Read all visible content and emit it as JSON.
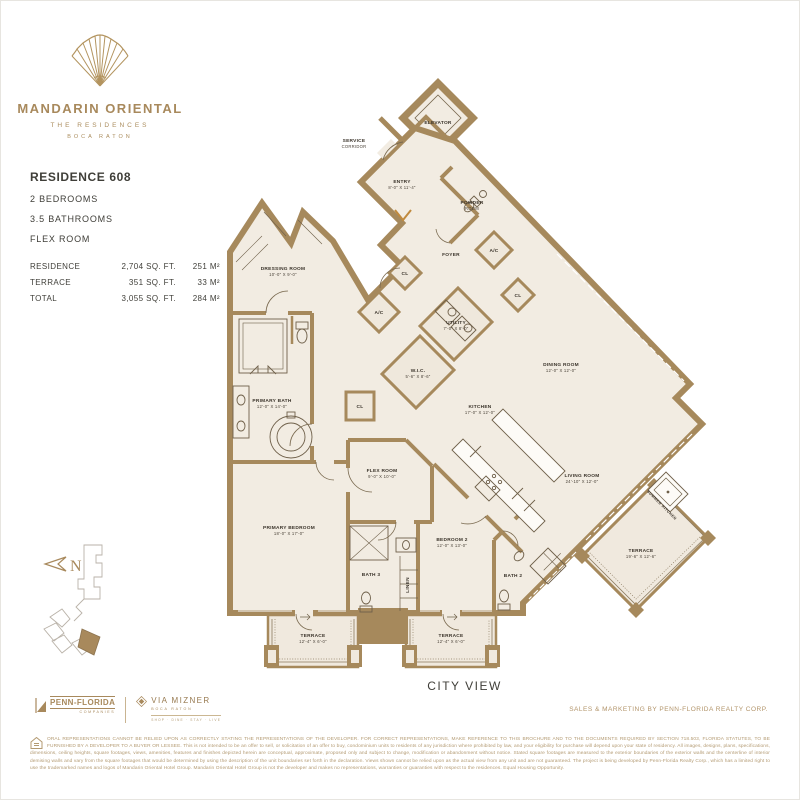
{
  "brand": {
    "name": "MANDARIN ORIENTAL",
    "line1": "THE RESIDENCES",
    "line2": "BOCA RATON"
  },
  "unit": {
    "title": "RESIDENCE 608",
    "features": [
      "2 BEDROOMS",
      "3.5 BATHROOMS",
      "FLEX ROOM"
    ],
    "areas": [
      {
        "label": "RESIDENCE",
        "sqft": "2,704 SQ. FT.",
        "sqm": "251 M²"
      },
      {
        "label": "TERRACE",
        "sqft": "351 SQ. FT.",
        "sqm": "33 M²"
      },
      {
        "label": "TOTAL",
        "sqft": "3,055 SQ. FT.",
        "sqm": "284 M²"
      }
    ]
  },
  "plan": {
    "view_label": "CITY VIEW",
    "compass": "N",
    "rooms": [
      {
        "t1": "ELEVATOR",
        "x": 438,
        "y": 124
      },
      {
        "t1": "SERVICE",
        "t2": "CORRIDOR",
        "x": 354,
        "y": 142
      },
      {
        "t1": "ENTRY",
        "t2": "8'-0\" X 11'-4\"",
        "x": 402,
        "y": 183
      },
      {
        "t1": "POWDER",
        "t2": "ROOM",
        "x": 472,
        "y": 204
      },
      {
        "t1": "FOYER",
        "x": 451,
        "y": 256
      },
      {
        "t1": "A/C",
        "x": 494,
        "y": 252
      },
      {
        "t1": "CL",
        "x": 518,
        "y": 297
      },
      {
        "t1": "CL",
        "x": 405,
        "y": 275
      },
      {
        "t1": "A/C",
        "x": 379,
        "y": 314
      },
      {
        "t1": "DRESSING ROOM",
        "t2": "10'-0\" X 9'-0\"",
        "x": 283,
        "y": 270
      },
      {
        "t1": "UTILITY",
        "t2": "7'-0\" X 8'-0\"",
        "x": 456,
        "y": 324
      },
      {
        "t1": "W.I.C.",
        "t2": "5'-6\" X 8'-6\"",
        "x": 418,
        "y": 372
      },
      {
        "t1": "CL",
        "x": 360,
        "y": 408
      },
      {
        "t1": "PRIMARY BATH",
        "t2": "12'-0\" X 14'-0\"",
        "x": 272,
        "y": 402
      },
      {
        "t1": "KITCHEN",
        "t2": "17'-0\" X 12'-0\"",
        "x": 480,
        "y": 408
      },
      {
        "t1": "DINING ROOM",
        "t2": "12'-0\" X 12'-0\"",
        "x": 561,
        "y": 366
      },
      {
        "t1": "LIVING ROOM",
        "t2": "24'-10\" X 12'-0\"",
        "x": 582,
        "y": 477
      },
      {
        "t1": "PRIMARY BEDROOM",
        "t2": "18'-0\" X 17'-0\"",
        "x": 289,
        "y": 529
      },
      {
        "t1": "FLEX ROOM",
        "t2": "9'-0\" X 10'-0\"",
        "x": 382,
        "y": 472
      },
      {
        "t1": "BATH 3",
        "x": 371,
        "y": 576
      },
      {
        "t1": "LINEN",
        "x": 409,
        "y": 585,
        "r": -90
      },
      {
        "t1": "BEDROOM 2",
        "t2": "12'-0\" X 13'-0\"",
        "x": 452,
        "y": 541
      },
      {
        "t1": "BATH 2",
        "x": 513,
        "y": 577
      },
      {
        "t1": "TERRACE",
        "t2": "12'-4\" X 6'-0\"",
        "x": 313,
        "y": 637
      },
      {
        "t1": "TERRACE",
        "t2": "12'-4\" X 6'-0\"",
        "x": 451,
        "y": 637
      },
      {
        "t1": "TERRACE",
        "t2": "19'-6\" X 12'-6\"",
        "x": 641,
        "y": 552
      },
      {
        "t1": "SUMMER KITCHEN",
        "x": 661,
        "y": 506,
        "r": 45,
        "small": true
      }
    ]
  },
  "footer": {
    "penn_name": "PENN-FLORIDA",
    "penn_sub": "COMPANIES",
    "via_name": "VIA MIZNER",
    "via_sub": "BOCA RATON",
    "via_tagline": "SHOP · DINE · STAY · LIVE",
    "sales": "SALES & MARKETING BY PENN-FLORIDA REALTY CORP.",
    "disclaimer": "ORAL REPRESENTATIONS CANNOT BE RELIED UPON AS CORRECTLY STATING THE REPRESENTATIONS OF THE DEVELOPER. FOR CORRECT REPRESENTATIONS, MAKE REFERENCE TO THIS BROCHURE AND TO THE DOCUMENTS REQUIRED BY SECTION 718.503, FLORIDA STATUTES, TO BE FURNISHED BY A DEVELOPER TO A BUYER OR LESSEE. This is not intended to be an offer to sell, or solicitation of an offer to buy, condominium units to residents of any jurisdiction where prohibited by law, and your eligibility for purchase will depend upon your state of residency. All images, designs, plans, specifications, dimensions, ceiling heights, square footages, views, amenities, features and finishes depicted herein are conceptual, approximate, proposed only and subject to change, modification or abandonment without notice. Stated square footages are measured to the exterior boundaries of the exterior walls and the centerline of interior demising walls and vary from the square footages that would be determined by using the description of the unit boundaries set forth in the declaration. Views shown cannot be relied upon as the actual view from any unit and are not guaranteed. The project is being developed by Penn-Florida Realty Corp., which has a limited right to use the trademarked names and logos of Mandarin Oriental Hotel Group. Mandarin Oriental Hotel Group is not the developer and makes no representations, warranties or guaranties with respect to the residences. Equal Housing Opportunity."
  }
}
